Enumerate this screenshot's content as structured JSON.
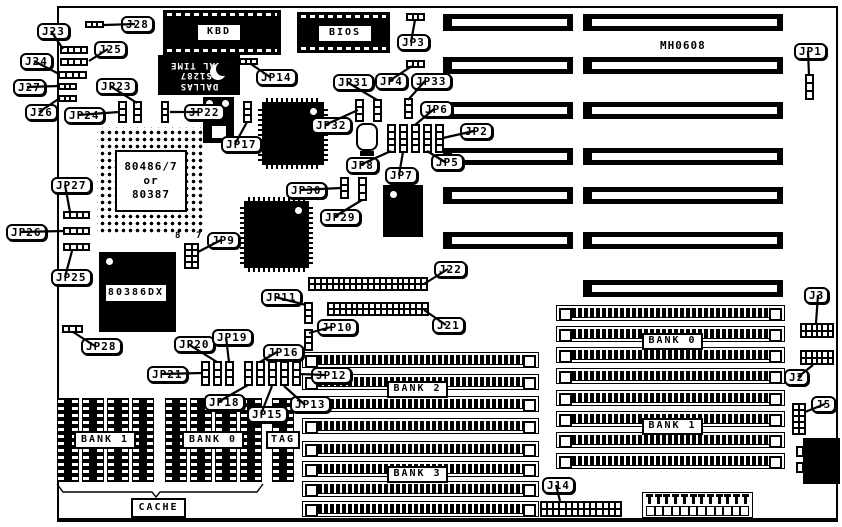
{
  "title": "MH0608",
  "colors": {
    "ink": "#000000",
    "board": "#ffffff"
  },
  "board": {
    "x": 57,
    "y": 6,
    "w": 781,
    "h": 516
  },
  "plain_texts": [
    {
      "text": "MH0608",
      "x": 660,
      "y": 39,
      "size": 11,
      "name": "board-model-text"
    },
    {
      "text": "8",
      "x": 175,
      "y": 231,
      "size": 9,
      "name": "jp9-pin8-text"
    },
    {
      "text": "7",
      "x": 196,
      "y": 231,
      "size": 9,
      "name": "jp9-pin7-text"
    }
  ],
  "callouts": [
    {
      "text": "J23",
      "x": 37,
      "y": 23,
      "tx": 63,
      "ty": 49
    },
    {
      "text": "J28",
      "x": 121,
      "y": 16,
      "tx": 104,
      "ty": 25
    },
    {
      "text": "J25",
      "x": 94,
      "y": 41,
      "tx": 89,
      "ty": 61
    },
    {
      "text": "J24",
      "x": 20,
      "y": 53,
      "tx": 59,
      "ty": 74
    },
    {
      "text": "J27",
      "x": 13,
      "y": 79,
      "tx": 59,
      "ty": 86
    },
    {
      "text": "J26",
      "x": 25,
      "y": 104,
      "tx": 60,
      "ty": 98
    },
    {
      "text": "JP23",
      "x": 96,
      "y": 78,
      "tx": 137,
      "ty": 103
    },
    {
      "text": "JP24",
      "x": 64,
      "y": 107,
      "tx": 119,
      "ty": 112
    },
    {
      "text": "JP22",
      "x": 184,
      "y": 104,
      "tx": 170,
      "ty": 112
    },
    {
      "text": "JP17",
      "x": 221,
      "y": 136,
      "tx": 247,
      "ty": 122
    },
    {
      "text": "JP14",
      "x": 256,
      "y": 69,
      "tx": 251,
      "ty": 64
    },
    {
      "text": "JP3",
      "x": 397,
      "y": 34,
      "tx": 415,
      "ty": 20
    },
    {
      "text": "JP4",
      "x": 375,
      "y": 73,
      "tx": 412,
      "ty": 66
    },
    {
      "text": "JP33",
      "x": 411,
      "y": 73,
      "tx": 408,
      "ty": 100
    },
    {
      "text": "JP31",
      "x": 333,
      "y": 74,
      "tx": 377,
      "ty": 100
    },
    {
      "text": "JP32",
      "x": 311,
      "y": 117,
      "tx": 358,
      "ty": 110
    },
    {
      "text": "JP6",
      "x": 420,
      "y": 101,
      "tx": 415,
      "ty": 125
    },
    {
      "text": "JP2",
      "x": 460,
      "y": 123,
      "tx": 443,
      "ty": 138
    },
    {
      "text": "JP5",
      "x": 431,
      "y": 154,
      "tx": 427,
      "ty": 151
    },
    {
      "text": "JP8",
      "x": 346,
      "y": 157,
      "tx": 391,
      "ty": 151
    },
    {
      "text": "JP7",
      "x": 385,
      "y": 167,
      "tx": 403,
      "ty": 152
    },
    {
      "text": "JP30",
      "x": 286,
      "y": 182,
      "tx": 341,
      "ty": 188
    },
    {
      "text": "JP29",
      "x": 320,
      "y": 209,
      "tx": 362,
      "ty": 200
    },
    {
      "text": "JP27",
      "x": 51,
      "y": 177,
      "tx": 70,
      "ty": 212
    },
    {
      "text": "JP26",
      "x": 6,
      "y": 224,
      "tx": 64,
      "ty": 231
    },
    {
      "text": "JP25",
      "x": 51,
      "y": 269,
      "tx": 72,
      "ty": 251
    },
    {
      "text": "JP9",
      "x": 207,
      "y": 232,
      "tx": 198,
      "ty": 252
    },
    {
      "text": "JP28",
      "x": 81,
      "y": 338,
      "tx": 73,
      "ty": 332
    },
    {
      "text": "JP11",
      "x": 261,
      "y": 289,
      "tx": 306,
      "ty": 305
    },
    {
      "text": "JP10",
      "x": 317,
      "y": 319,
      "tx": 309,
      "ty": 333
    },
    {
      "text": "J22",
      "x": 434,
      "y": 261,
      "tx": 424,
      "ty": 284
    },
    {
      "text": "J21",
      "x": 432,
      "y": 317,
      "tx": 424,
      "ty": 310
    },
    {
      "text": "JP20",
      "x": 174,
      "y": 336,
      "tx": 217,
      "ty": 362
    },
    {
      "text": "JP19",
      "x": 212,
      "y": 329,
      "tx": 229,
      "ty": 362
    },
    {
      "text": "JP21",
      "x": 147,
      "y": 366,
      "tx": 202,
      "ty": 373
    },
    {
      "text": "JP16",
      "x": 263,
      "y": 344,
      "tx": 260,
      "ty": 362
    },
    {
      "text": "JP12",
      "x": 311,
      "y": 367,
      "tx": 300,
      "ty": 374
    },
    {
      "text": "JP18",
      "x": 204,
      "y": 394,
      "tx": 248,
      "ty": 385
    },
    {
      "text": "JP15",
      "x": 247,
      "y": 406,
      "tx": 272,
      "ty": 386
    },
    {
      "text": "JP13",
      "x": 290,
      "y": 396,
      "tx": 284,
      "ty": 386
    },
    {
      "text": "JP1",
      "x": 794,
      "y": 43,
      "tx": 809,
      "ty": 75
    },
    {
      "text": "J3",
      "x": 804,
      "y": 287,
      "tx": 816,
      "ty": 323
    },
    {
      "text": "J2",
      "x": 784,
      "y": 369,
      "tx": 813,
      "ty": 365
    },
    {
      "text": "J5",
      "x": 811,
      "y": 396,
      "tx": 805,
      "ty": 412
    },
    {
      "text": "J14",
      "x": 542,
      "y": 477,
      "tx": 560,
      "ty": 501
    }
  ],
  "chip_labels": [
    {
      "name": "kbd-label",
      "lines": [
        "KBD"
      ],
      "x": 196,
      "y": 23,
      "w": 46,
      "h": 19
    },
    {
      "name": "bios-label",
      "lines": [
        "BIOS"
      ],
      "x": 317,
      "y": 24,
      "w": 56,
      "h": 19
    },
    {
      "name": "cpu-socket-label",
      "lines": [
        "80486/7",
        "or",
        "80387"
      ],
      "x": 115,
      "y": 150,
      "w": 72,
      "h": 62
    },
    {
      "name": "cpu-386-label",
      "lines": [
        "80386DX"
      ],
      "x": 104,
      "y": 283,
      "w": 64,
      "h": 20
    },
    {
      "name": "bank1-cache-label",
      "lines": [
        "BANK 1"
      ],
      "x": 74,
      "y": 431,
      "w": 62,
      "h": 18
    },
    {
      "name": "bank0-cache-label",
      "lines": [
        "BANK 0"
      ],
      "x": 182,
      "y": 431,
      "w": 62,
      "h": 18
    },
    {
      "name": "tag-label",
      "lines": [
        "TAG"
      ],
      "x": 266,
      "y": 431,
      "w": 34,
      "h": 18
    },
    {
      "name": "bank2-label",
      "lines": [
        "BANK 2"
      ],
      "x": 387,
      "y": 381,
      "w": 61,
      "h": 17
    },
    {
      "name": "bank3-label",
      "lines": [
        "BANK 3"
      ],
      "x": 387,
      "y": 466,
      "w": 61,
      "h": 17
    },
    {
      "name": "bank0-simm-label",
      "lines": [
        "BANK 0"
      ],
      "x": 642,
      "y": 333,
      "w": 61,
      "h": 17
    },
    {
      "name": "bank1-simm-label",
      "lines": [
        "BANK 1"
      ],
      "x": 642,
      "y": 418,
      "w": 61,
      "h": 17
    },
    {
      "name": "cache-label",
      "lines": [
        "CACHE"
      ],
      "x": 131,
      "y": 498,
      "w": 55,
      "h": 20
    }
  ],
  "rtc_chip": {
    "name": "dallas-rtc-chip",
    "x": 158,
    "y": 55,
    "w": 82,
    "h": 40,
    "lines": [
      "DALLAS",
      "DS1287",
      "REAL TIME"
    ]
  },
  "h_jumpers": [
    {
      "name": "jumper-j23",
      "x": 60,
      "y": 46,
      "w": 28,
      "h": 8,
      "cells": 4
    },
    {
      "name": "jumper-j28",
      "x": 85,
      "y": 21,
      "w": 19,
      "h": 7,
      "cells": 3
    },
    {
      "name": "jumper-j25",
      "x": 60,
      "y": 58,
      "w": 28,
      "h": 8,
      "cells": 4
    },
    {
      "name": "jumper-j24",
      "x": 58,
      "y": 71,
      "w": 29,
      "h": 8,
      "cells": 4
    },
    {
      "name": "jumper-j27",
      "x": 58,
      "y": 83,
      "w": 19,
      "h": 7,
      "cells": 3
    },
    {
      "name": "jumper-j26",
      "x": 58,
      "y": 95,
      "w": 19,
      "h": 7,
      "cells": 3
    },
    {
      "name": "jumper-jp14",
      "x": 239,
      "y": 58,
      "w": 19,
      "h": 7,
      "cells": 3
    },
    {
      "name": "jumper-jp3",
      "x": 406,
      "y": 13,
      "w": 19,
      "h": 8,
      "cells": 3
    },
    {
      "name": "jumper-jp4",
      "x": 406,
      "y": 60,
      "w": 19,
      "h": 8,
      "cells": 3
    },
    {
      "name": "jumper-jp27",
      "x": 63,
      "y": 211,
      "w": 27,
      "h": 8,
      "cells": 4
    },
    {
      "name": "jumper-jp26",
      "x": 63,
      "y": 227,
      "w": 27,
      "h": 8,
      "cells": 4
    },
    {
      "name": "jumper-jp25",
      "x": 63,
      "y": 243,
      "w": 27,
      "h": 8,
      "cells": 4
    },
    {
      "name": "jumper-jp28",
      "x": 62,
      "y": 325,
      "w": 21,
      "h": 8,
      "cells": 3
    }
  ],
  "v_jumpers": [
    {
      "name": "jumper-jp23",
      "x": 133,
      "y": 101,
      "w": 9,
      "h": 22,
      "cells": 3
    },
    {
      "name": "jumper-jp24",
      "x": 118,
      "y": 101,
      "w": 9,
      "h": 22,
      "cells": 3
    },
    {
      "name": "jumper-jp22",
      "x": 161,
      "y": 101,
      "w": 8,
      "h": 22,
      "cells": 3
    },
    {
      "name": "jumper-jp17",
      "x": 243,
      "y": 101,
      "w": 9,
      "h": 22,
      "cells": 3
    },
    {
      "name": "jumper-jp31",
      "x": 373,
      "y": 99,
      "w": 9,
      "h": 23,
      "cells": 3
    },
    {
      "name": "jumper-jp32",
      "x": 355,
      "y": 99,
      "w": 9,
      "h": 23,
      "cells": 3
    },
    {
      "name": "jumper-jp33",
      "x": 404,
      "y": 98,
      "w": 9,
      "h": 21,
      "cells": 3
    },
    {
      "name": "jumper-jp8",
      "x": 387,
      "y": 124,
      "w": 9,
      "h": 29,
      "cells": 4
    },
    {
      "name": "jumper-jp7",
      "x": 399,
      "y": 124,
      "w": 9,
      "h": 29,
      "cells": 4
    },
    {
      "name": "jumper-jp6",
      "x": 411,
      "y": 124,
      "w": 9,
      "h": 29,
      "cells": 4
    },
    {
      "name": "jumper-jp5",
      "x": 423,
      "y": 124,
      "w": 9,
      "h": 29,
      "cells": 4
    },
    {
      "name": "jumper-jp2",
      "x": 435,
      "y": 124,
      "w": 9,
      "h": 29,
      "cells": 4
    },
    {
      "name": "jumper-jp30",
      "x": 340,
      "y": 177,
      "w": 9,
      "h": 22,
      "cells": 3
    },
    {
      "name": "jumper-jp29",
      "x": 358,
      "y": 177,
      "w": 9,
      "h": 24,
      "cells": 3
    },
    {
      "name": "jumper-jp11",
      "x": 304,
      "y": 302,
      "w": 9,
      "h": 22,
      "cells": 3
    },
    {
      "name": "jumper-jp10",
      "x": 304,
      "y": 329,
      "w": 9,
      "h": 22,
      "cells": 3
    },
    {
      "name": "jumper-jp21",
      "x": 201,
      "y": 361,
      "w": 9,
      "h": 25,
      "cells": 3
    },
    {
      "name": "jumper-jp20",
      "x": 213,
      "y": 361,
      "w": 9,
      "h": 25,
      "cells": 3
    },
    {
      "name": "jumper-jp19",
      "x": 225,
      "y": 361,
      "w": 9,
      "h": 25,
      "cells": 3
    },
    {
      "name": "jumper-jp18",
      "x": 244,
      "y": 361,
      "w": 9,
      "h": 25,
      "cells": 3
    },
    {
      "name": "jumper-jp16",
      "x": 256,
      "y": 361,
      "w": 9,
      "h": 25,
      "cells": 3
    },
    {
      "name": "jumper-jp15",
      "x": 268,
      "y": 361,
      "w": 9,
      "h": 25,
      "cells": 3
    },
    {
      "name": "jumper-jp13",
      "x": 280,
      "y": 361,
      "w": 9,
      "h": 25,
      "cells": 3
    },
    {
      "name": "jumper-jp12",
      "x": 292,
      "y": 361,
      "w": 9,
      "h": 25,
      "cells": 3
    },
    {
      "name": "jumper-jp1",
      "x": 805,
      "y": 74,
      "w": 9,
      "h": 26,
      "cells": 3
    }
  ],
  "grids": [
    {
      "name": "jumper-block-jp9",
      "x": 184,
      "y": 243,
      "w": 15,
      "h": 26,
      "cols": 2,
      "rows": 4
    },
    {
      "name": "header-j5",
      "x": 792,
      "y": 403,
      "w": 14,
      "h": 32,
      "cols": 2,
      "rows": 5
    }
  ],
  "pin_headers": [
    {
      "name": "header-j22",
      "x": 308,
      "y": 277,
      "w": 120,
      "h": 14,
      "cols": 20
    },
    {
      "name": "header-j21",
      "x": 327,
      "y": 302,
      "w": 102,
      "h": 14,
      "cols": 17
    },
    {
      "name": "header-j3",
      "x": 800,
      "y": 323,
      "w": 34,
      "h": 15,
      "cols": 6
    },
    {
      "name": "header-j2",
      "x": 800,
      "y": 350,
      "w": 34,
      "h": 15,
      "cols": 6
    },
    {
      "name": "header-j14",
      "x": 540,
      "y": 501,
      "w": 82,
      "h": 16,
      "cols": 13
    }
  ],
  "isa_slots": {
    "left": {
      "x": 443,
      "w": 130,
      "h": 17,
      "rows": [
        14,
        57,
        102,
        148,
        187,
        232
      ]
    },
    "right": {
      "x": 583,
      "w": 200,
      "h": 17,
      "rows": [
        14,
        57,
        102,
        148,
        187,
        232,
        280
      ]
    }
  },
  "simm_sockets": {
    "left_group": {
      "x": 302,
      "w": 237,
      "h": 16,
      "rows": [
        352,
        374,
        396,
        418,
        441,
        461,
        481,
        501
      ]
    },
    "right_group": {
      "x": 556,
      "w": 229,
      "h": 16,
      "rows": [
        305,
        326,
        347,
        368,
        390,
        411,
        432,
        453
      ]
    }
  },
  "cache_dip_chips": {
    "y": 398,
    "h": 84,
    "w": 22,
    "bank1_x": [
      57,
      82,
      107,
      132
    ],
    "bank0_x": [
      165,
      190,
      215,
      240
    ],
    "tag_x": [
      272
    ]
  },
  "black_chips": [
    {
      "name": "kbd-controller-chip",
      "x": 163,
      "y": 10,
      "w": 118,
      "h": 45,
      "kind": "dashed"
    },
    {
      "name": "bios-rom-chip",
      "x": 297,
      "y": 12,
      "w": 93,
      "h": 41,
      "kind": "dashed"
    },
    {
      "name": "rtc-crystal-block",
      "x": 203,
      "y": 97,
      "w": 31,
      "h": 46,
      "kind": "rtc"
    },
    {
      "name": "chipset-qfp-1",
      "x": 262,
      "y": 102,
      "w": 62,
      "h": 63,
      "kind": "qfp",
      "dot": "tr"
    },
    {
      "name": "chipset-qfp-2",
      "x": 244,
      "y": 201,
      "w": 65,
      "h": 67,
      "kind": "qfp",
      "dot": "tr"
    },
    {
      "name": "ic-below-jp7",
      "x": 383,
      "y": 185,
      "w": 40,
      "h": 52,
      "kind": "plain",
      "dot": "tl"
    },
    {
      "name": "cpu-80386dx-chip",
      "x": 99,
      "y": 252,
      "w": 77,
      "h": 80,
      "kind": "plain",
      "dot": "tl"
    },
    {
      "name": "keyboard-din-connector",
      "x": 803,
      "y": 438,
      "w": 37,
      "h": 46,
      "kind": "din"
    }
  ],
  "cpu_socket": {
    "name": "cpu-pga-socket",
    "x": 97,
    "y": 127,
    "w": 107,
    "h": 106
  },
  "crystal": {
    "name": "crystal-oscillator",
    "x": 356,
    "y": 123,
    "w": 22,
    "h": 28
  },
  "power_connector": {
    "name": "power-connector",
    "x": 642,
    "y": 492,
    "w": 111,
    "h": 26,
    "pins": 12
  },
  "cache_brace": {
    "points": [
      [
        57,
        484
      ],
      [
        63,
        492
      ],
      [
        152,
        492
      ],
      [
        156,
        497
      ],
      [
        160,
        492
      ],
      [
        257,
        492
      ],
      [
        263,
        484
      ]
    ]
  }
}
